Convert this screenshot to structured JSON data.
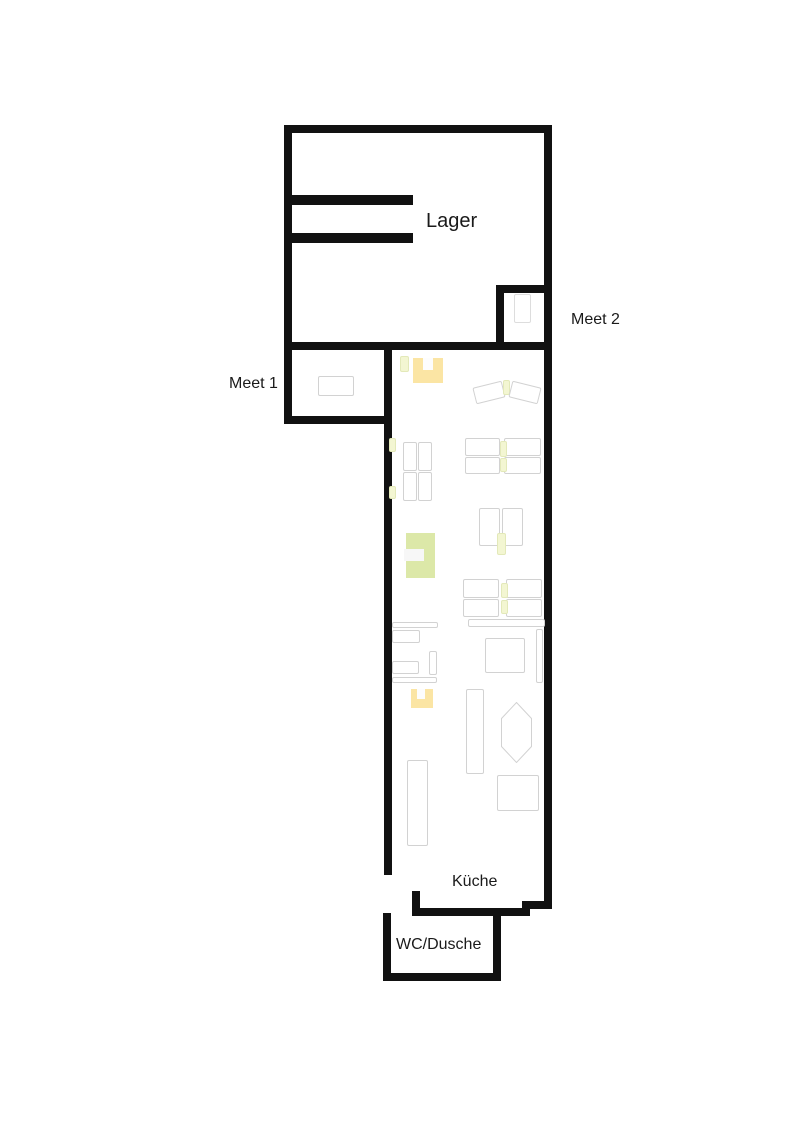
{
  "title": "Office floor plan",
  "colors": {
    "wall": "#111111",
    "furniture_outline": "#d2d2d2",
    "accent_green_light": "#F3F6D2",
    "accent_green_border": "#E3E9B9",
    "accent_green": "#DCE8A8",
    "accent_yellow": "#FBE5A4",
    "text": "#1a1a1a",
    "background": "#ffffff"
  },
  "rooms": {
    "lager": {
      "label": "Lager"
    },
    "meet2": {
      "label": "Meet 2"
    },
    "meet1": {
      "label": "Meet 1"
    },
    "kueche": {
      "label": "Küche"
    },
    "wc": {
      "label": "WC/Dusche"
    }
  }
}
